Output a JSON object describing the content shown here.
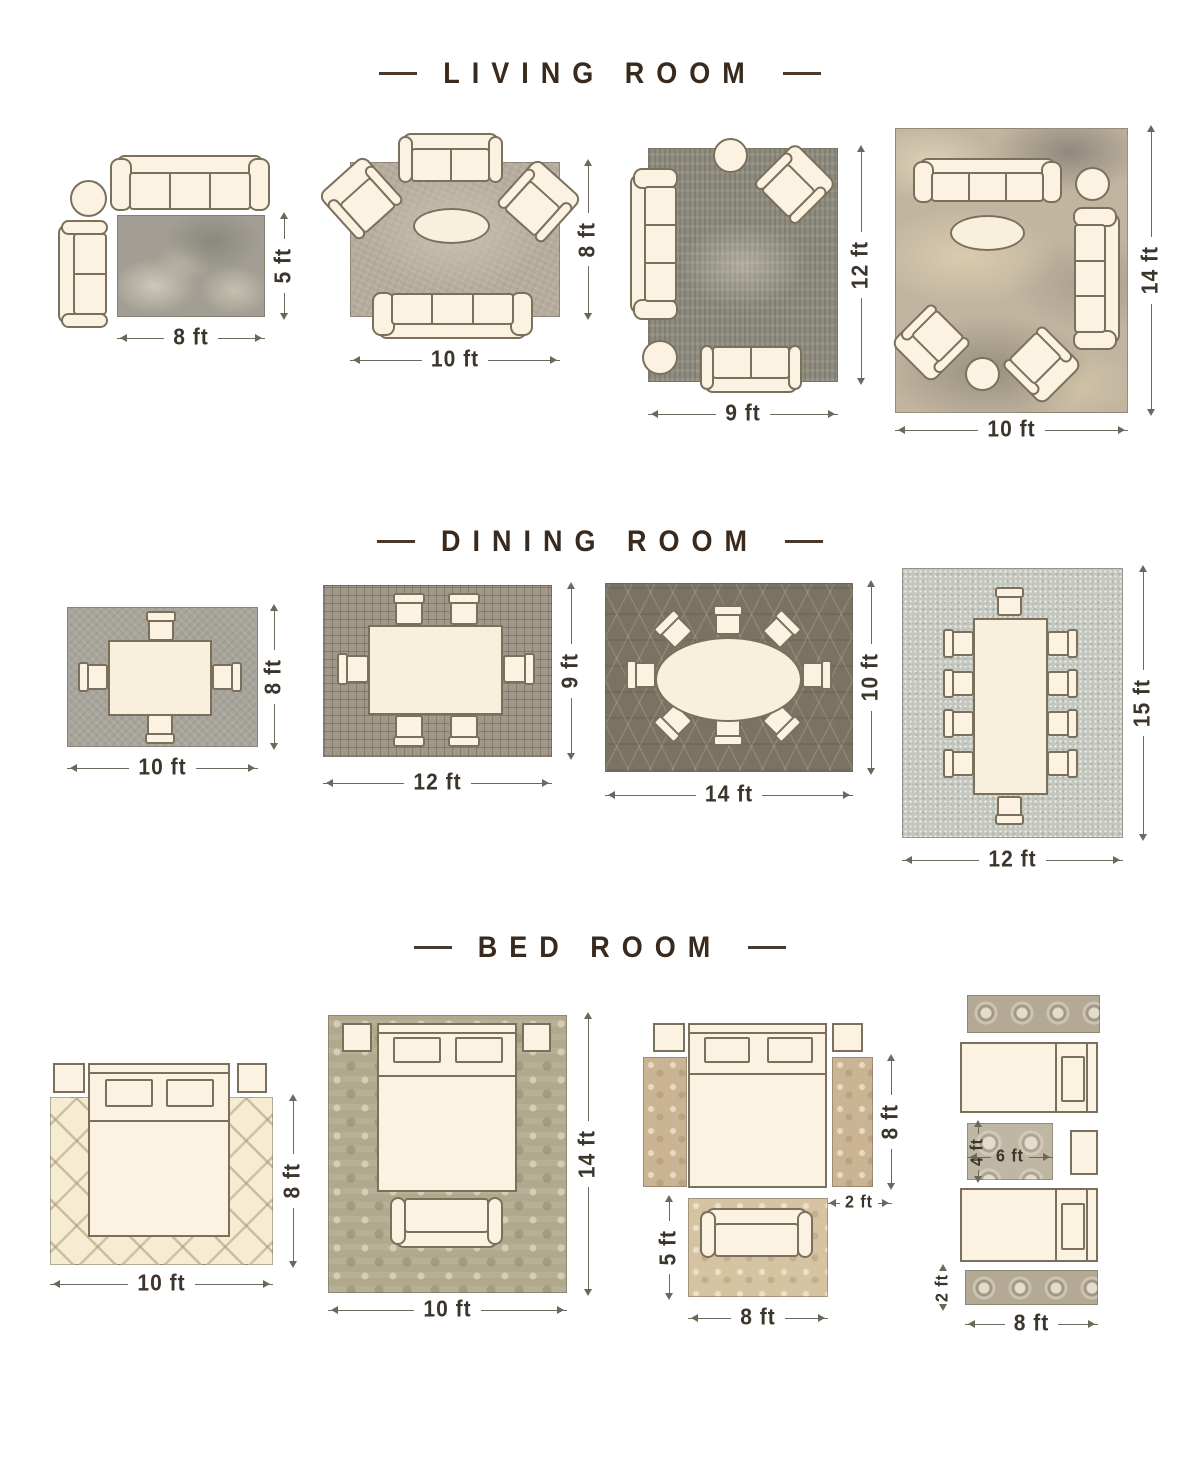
{
  "colors": {
    "background": "#ffffff",
    "title_text": "#3a2a1d",
    "dimension_text": "#3b352c",
    "furniture_fill": "#fcf2e2",
    "furniture_outline": "#7b705c"
  },
  "sections": [
    {
      "title": "LIVING ROOM",
      "layouts": [
        {
          "name": "living-8x5",
          "furniture": [
            "sofa-3-seat",
            "round-side-table",
            "loveseat"
          ],
          "width_label": "8 ft",
          "height_label": "5 ft"
        },
        {
          "name": "living-10x8",
          "furniture": [
            "loveseat",
            "armchair",
            "armchair",
            "oval-coffee-table",
            "sofa-3-seat"
          ],
          "width_label": "10 ft",
          "height_label": "8 ft"
        },
        {
          "name": "living-9x12",
          "furniture": [
            "round-side-table",
            "armchair",
            "sofa-3-seat",
            "round-ottoman",
            "loveseat"
          ],
          "width_label": "9 ft",
          "height_label": "12 ft"
        },
        {
          "name": "living-10x14",
          "furniture": [
            "sofa-3-seat",
            "round-side-table",
            "sofa-3-seat",
            "oval-coffee-table",
            "armchair",
            "round-ottoman",
            "armchair"
          ],
          "width_label": "10 ft",
          "height_label": "14 ft"
        }
      ]
    },
    {
      "title": "DINING ROOM",
      "layouts": [
        {
          "name": "dining-10x8",
          "furniture": [
            "dining-table",
            "dining-chair-x4"
          ],
          "width_label": "10 ft",
          "height_label": "8 ft"
        },
        {
          "name": "dining-12x9",
          "furniture": [
            "dining-table",
            "dining-chair-x6"
          ],
          "width_label": "12 ft",
          "height_label": "9 ft"
        },
        {
          "name": "dining-14x10",
          "furniture": [
            "oval-dining-table",
            "dining-chair-x8"
          ],
          "width_label": "14 ft",
          "height_label": "10 ft"
        },
        {
          "name": "dining-12x15",
          "furniture": [
            "long-dining-table",
            "dining-chair-x10"
          ],
          "width_label": "12 ft",
          "height_label": "15 ft"
        }
      ]
    },
    {
      "title": "BED ROOM",
      "layouts": [
        {
          "name": "bed-10x8",
          "furniture": [
            "nightstand",
            "nightstand",
            "queen-bed"
          ],
          "width_label": "10 ft",
          "height_label": "8 ft"
        },
        {
          "name": "bed-10x14",
          "furniture": [
            "nightstand",
            "nightstand",
            "queen-bed",
            "bench"
          ],
          "width_label": "10 ft",
          "height_label": "14 ft"
        },
        {
          "name": "bed-runners-accent",
          "furniture": [
            "nightstand",
            "nightstand",
            "queen-bed",
            "runner-rug",
            "runner-rug",
            "bench",
            "accent-rug"
          ],
          "runner_height": "8 ft",
          "runner_width": "2 ft",
          "accent_height": "5 ft",
          "accent_width": "8 ft"
        },
        {
          "name": "bed-twin-runners",
          "furniture": [
            "runner-rug",
            "twin-bed",
            "between-rug",
            "nightstand",
            "twin-bed",
            "runner-rug"
          ],
          "between_height": "4 ft",
          "between_width": "6 ft",
          "runner_height": "2 ft",
          "runner_width": "8 ft"
        }
      ]
    }
  ]
}
